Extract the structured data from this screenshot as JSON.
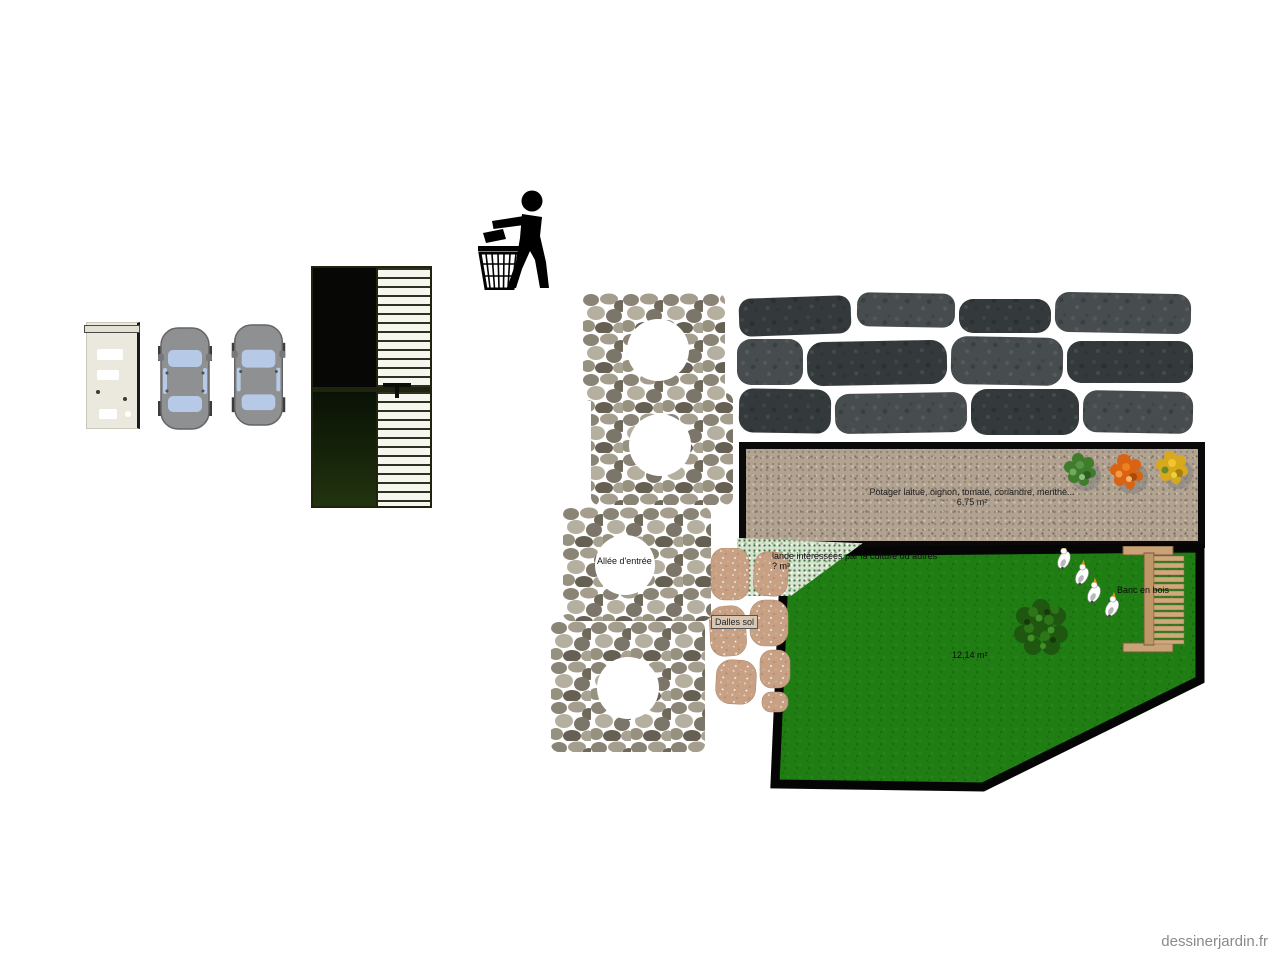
{
  "site": {
    "watermark": "dessinerjardin.fr"
  },
  "plan": {
    "potager": {
      "label": "Potager laitue, oignon, tomate, coriandre, menthe...",
      "area": "6,75 m²"
    },
    "lawn": {
      "area": "12,14 m²"
    },
    "bench": {
      "label": "Banc en bois"
    },
    "culture_zone": {
      "label": "lande intéressées par la culture ou autres",
      "area": "? m²"
    },
    "entrance_path": {
      "label": "Allée d'entrée"
    },
    "floor_slabs": {
      "label": "Dalles sol"
    }
  },
  "icons": {
    "litter": "litter-disposal-icon",
    "car": "car-top-view-icon",
    "appliance": "appliance-top-view-icon",
    "pergola": "pergola-top-view-icon",
    "stone_circle": "stone-paving-circle-icon",
    "stone_wall": "stone-wall-icon",
    "flagstones": "flagstone-path-icon",
    "tree": "tree-top-view-icon",
    "geese": "geese-icon",
    "bench": "wooden-bench-icon",
    "shrubs": [
      "green-shrub-icon",
      "orange-shrub-icon",
      "yellow-shrub-icon"
    ]
  },
  "colors": {
    "lawn_green": "#1f7d14",
    "potager_fill": "#b1a291",
    "wall_stone": "#3a3f42",
    "flagstone": "#c8a184",
    "wood": "#c9a277",
    "border_black": "#0a0a0a",
    "watermark_gray": "#8a8a8a"
  }
}
